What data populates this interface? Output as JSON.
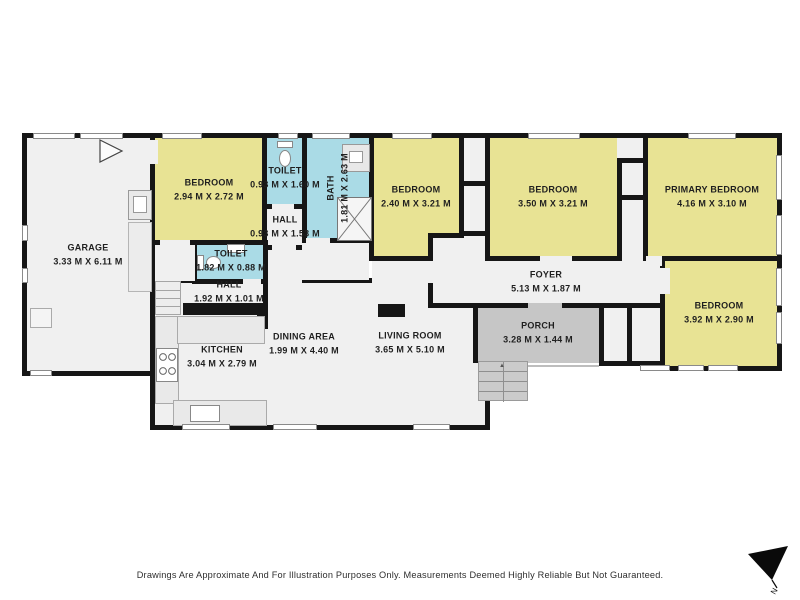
{
  "rooms": {
    "garage": {
      "name": "GARAGE",
      "dims": "3.33 M X 6.11 M"
    },
    "bedroom1": {
      "name": "BEDROOM",
      "dims": "2.94 M X 2.72 M"
    },
    "toilet1": {
      "name": "TOILET",
      "dims": "0.93 M X 1.60 M"
    },
    "hall1": {
      "name": "HALL",
      "dims": "0.93 M X 1.53 M"
    },
    "bath": {
      "name": "BATH",
      "dims": "1.81 M X 2.63 M"
    },
    "bedroom2": {
      "name": "BEDROOM",
      "dims": "2.40 M X 3.21 M"
    },
    "bedroom3": {
      "name": "BEDROOM",
      "dims": "3.50 M X 3.21 M"
    },
    "primary": {
      "name": "PRIMARY BEDROOM",
      "dims": "4.16 M X 3.10 M"
    },
    "bedroom4": {
      "name": "BEDROOM",
      "dims": "3.92 M X 2.90 M"
    },
    "foyer": {
      "name": "FOYER",
      "dims": "5.13 M X 1.87 M"
    },
    "porch": {
      "name": "PORCH",
      "dims": "3.28 M X 1.44 M"
    },
    "toilet2": {
      "name": "TOILET",
      "dims": "1.82 M X 0.88 M"
    },
    "hall2": {
      "name": "HALL",
      "dims": "1.92 M X 1.01 M"
    },
    "kitchen": {
      "name": "KITCHEN",
      "dims": "3.04 M X 2.79 M"
    },
    "dining": {
      "name": "DINING AREA",
      "dims": "1.99 M X 4.40 M"
    },
    "living": {
      "name": "LIVING ROOM",
      "dims": "3.65 M X 5.10 M"
    }
  },
  "colors": {
    "bedroom_fill": "#e8e394",
    "wet_fill": "#aadbe6",
    "floor_fill": "#f0f0f0",
    "porch_fill": "#c6c6c6",
    "wall": "#161616"
  },
  "footer": {
    "disclaimer": "Drawings Are Approximate And For Illustration Purposes Only. Measurements Deemed Highly Reliable But Not Guaranteed."
  },
  "compass": {
    "label": "N"
  }
}
